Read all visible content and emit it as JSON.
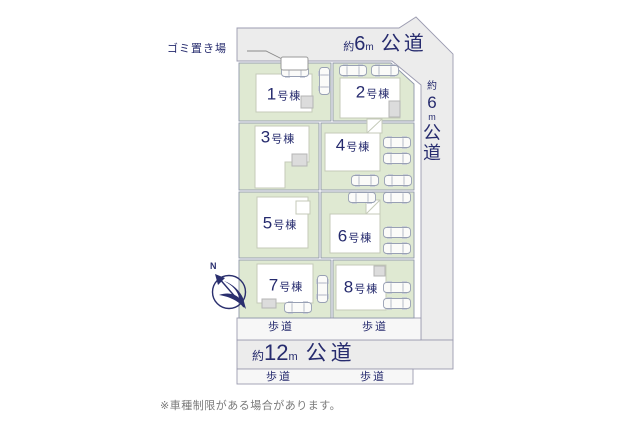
{
  "labels": {
    "garbage": "ゴミ置き場",
    "sidewalk": "歩道",
    "footnote": "※車種制限がある場合があります。",
    "compass_north": "N"
  },
  "roads": {
    "top": {
      "approx": "約",
      "width": "6",
      "unit": "m",
      "name": "公道"
    },
    "right": {
      "chars": [
        "約",
        "6",
        "m",
        "公",
        "道"
      ]
    },
    "bottom": {
      "approx": "約",
      "width": "12",
      "unit": "m",
      "name": "公道"
    }
  },
  "lots": [
    {
      "num": "1",
      "suffix": "号棟"
    },
    {
      "num": "2",
      "suffix": "号棟"
    },
    {
      "num": "3",
      "suffix": "号棟"
    },
    {
      "num": "4",
      "suffix": "号棟"
    },
    {
      "num": "5",
      "suffix": "号棟"
    },
    {
      "num": "6",
      "suffix": "号棟"
    },
    {
      "num": "7",
      "suffix": "号棟"
    },
    {
      "num": "8",
      "suffix": "号棟"
    }
  ],
  "colors": {
    "road_fill": "#ececec",
    "sidewalk_fill": "#f7f7f7",
    "lot_fill": "#dfe9d2",
    "line": "#9b9bb0",
    "building_stroke": "#c4cab8",
    "text_navy": "#262b6e",
    "footnote_gray": "#7a7a7a"
  }
}
